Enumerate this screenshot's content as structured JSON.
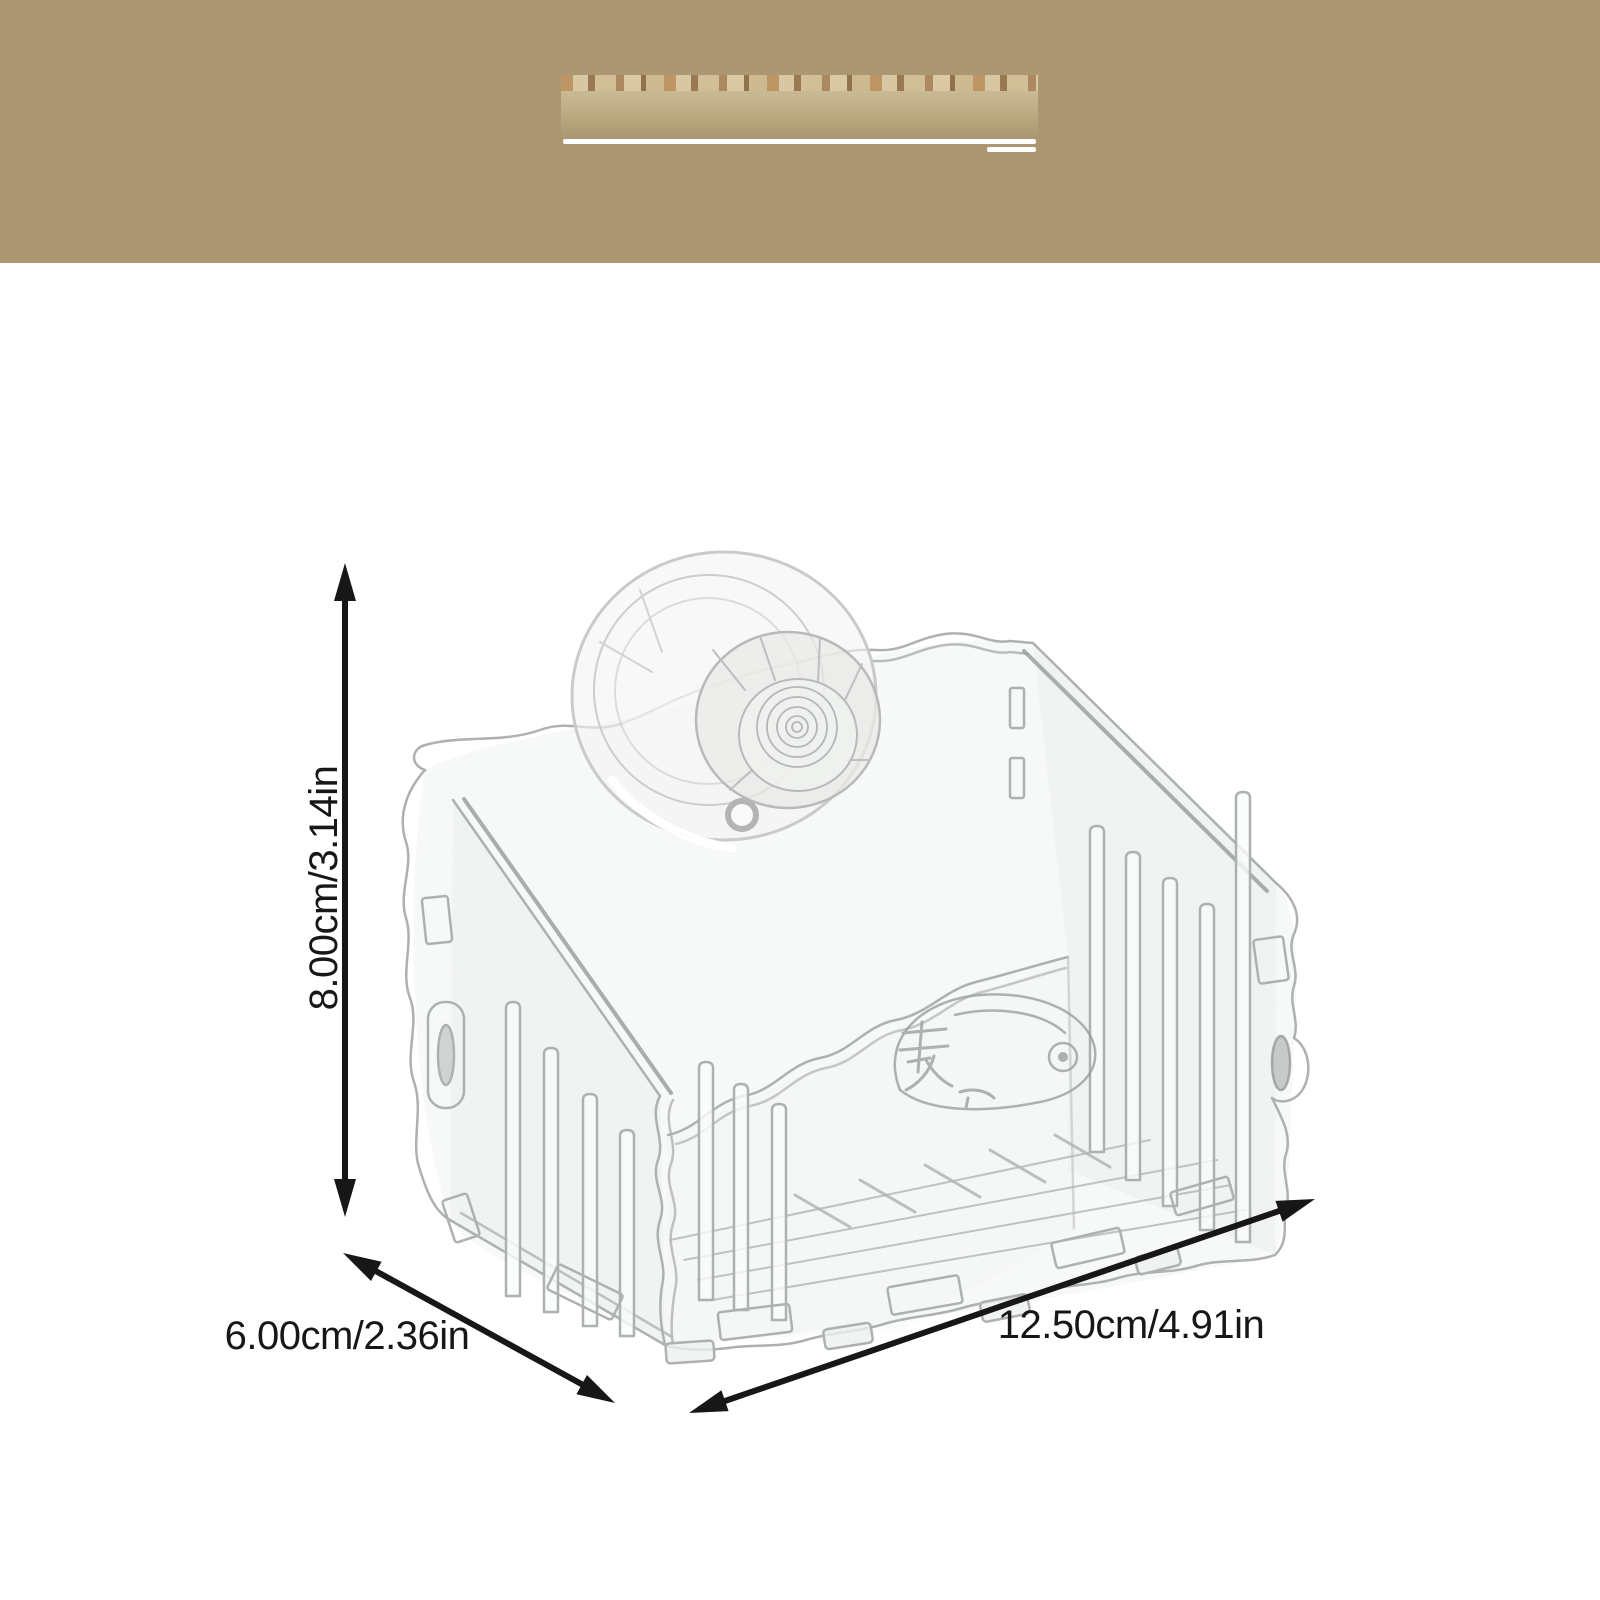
{
  "banner": {
    "color": "#ab9772",
    "patch_color": "#c8b892",
    "underline_color": "#ffffff"
  },
  "product": {
    "kind_icon": "clear-acrylic-suction-cup-caddy",
    "line_color": "#aeb1b1",
    "fill_color": "#f0f2f2",
    "watermark_color": "#9aa0a0"
  },
  "dimensions": {
    "height": {
      "label": "8.00cm/3.14in"
    },
    "depth": {
      "label": "6.00cm/2.36in"
    },
    "length": {
      "label": "12.50cm/4.91in"
    }
  },
  "annotation": {
    "color": "#171717"
  }
}
